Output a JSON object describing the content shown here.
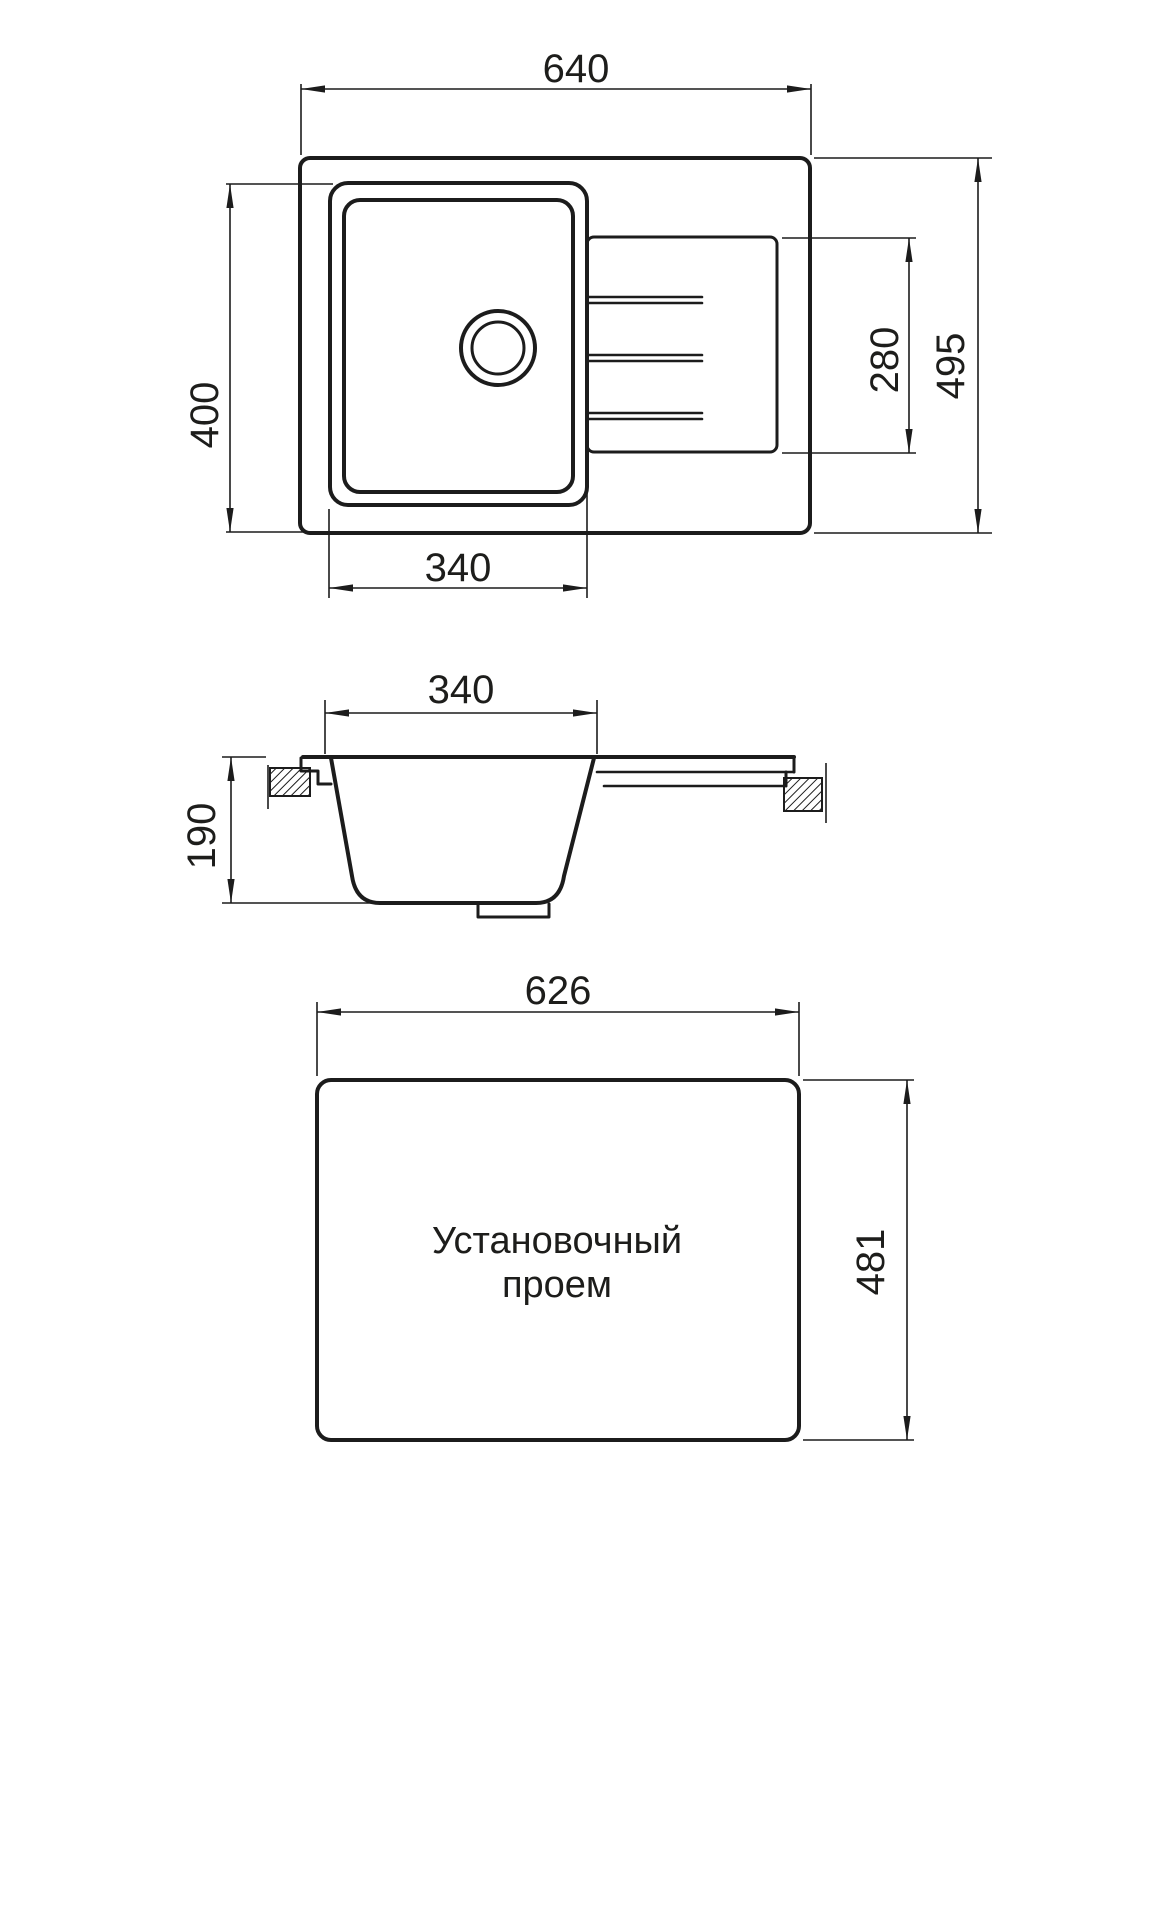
{
  "drawing": {
    "background": "#ffffff",
    "line_color": "#1c1c1c",
    "text_color": "#1d1d1b",
    "top_view": {
      "dim_overall_width": "640",
      "dim_bowl_depth": "400",
      "dim_bowl_width": "340",
      "dim_drainboard_width": "280",
      "dim_overall_depth": "495"
    },
    "section_view": {
      "dim_bowl_top_width": "340",
      "dim_bowl_height": "190"
    },
    "cutout_view": {
      "caption_line1": "Установочный",
      "caption_line2": "проем",
      "dim_width": "626",
      "dim_height": "481"
    }
  }
}
